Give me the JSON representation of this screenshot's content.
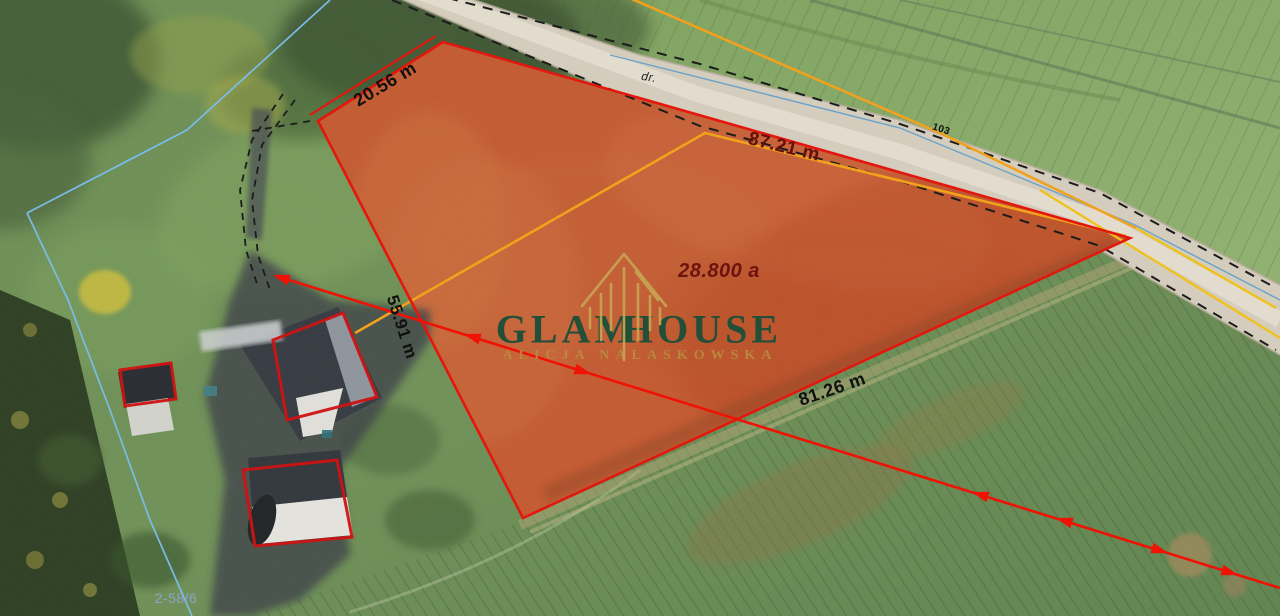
{
  "labels": {
    "top_edge": "20.56 m",
    "road_edge": "87.21 m",
    "west_edge": "55.91 m",
    "south_edge": "81.26 m",
    "area": "28.800 a",
    "road": "dr.",
    "parcel_number": "103",
    "plot_reference": "2-58/6"
  },
  "watermark": {
    "word_left": "GLAM",
    "word_right": "HOUSE",
    "subtitle": "ALICJA NALASKOWSKA"
  },
  "colors": {
    "parcel_outline": "#e3170d",
    "inner_boundary": "#f2a11d",
    "survey_line_blue": "#79bce8",
    "arrow_red": "#ef1205",
    "brand_green": "#1d4f39",
    "brand_gold": "#c8a452",
    "measurement_text": "#101010",
    "measurement_dark_red": "#64110a",
    "reference_blue": "#8fa6d8"
  }
}
